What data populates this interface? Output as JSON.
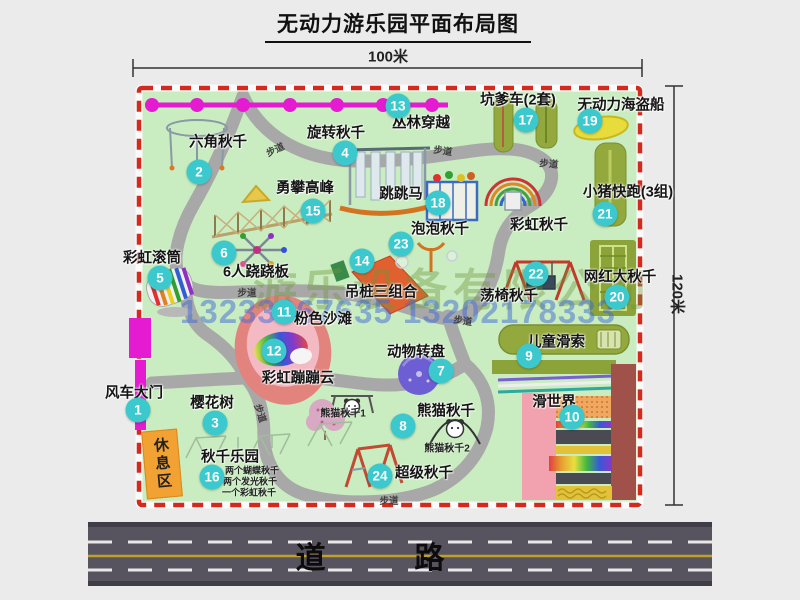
{
  "title": "无动力游乐园平面布局图",
  "dimensions": {
    "top": "100米",
    "right": "120米"
  },
  "road": {
    "label": "道  路"
  },
  "rest_area": {
    "label": "休息区"
  },
  "watermark": {
    "company": "游乐设备有限公司",
    "phones": "13233867635 13202178333"
  },
  "colors": {
    "park_green": "#c9ecc0",
    "border_red": "#d4291c",
    "badge_teal": "#3cc9cd",
    "road_gray": "#57535f",
    "zipline_magenta": "#e41bd0",
    "rest_area_orange": "#f2a233",
    "watermark_green": "rgba(110,150,60,0.40)",
    "watermark_blue": "rgba(64,106,216,0.50)"
  },
  "attractions": [
    {
      "num": "1",
      "label": "风车大门",
      "badge": [
        138,
        410
      ],
      "text": [
        134,
        392
      ]
    },
    {
      "num": "2",
      "label": "六角秋千",
      "badge": [
        199,
        172
      ],
      "text": [
        218,
        141
      ]
    },
    {
      "num": "3",
      "label": "樱花树",
      "badge": [
        215,
        423
      ],
      "text": [
        212,
        402
      ]
    },
    {
      "num": "4",
      "label": "旋转秋千",
      "badge": [
        345,
        153
      ],
      "text": [
        336,
        132
      ]
    },
    {
      "num": "5",
      "label": "彩虹滚筒",
      "badge": [
        160,
        278
      ],
      "text": [
        152,
        257
      ]
    },
    {
      "num": "6",
      "label": "6人跷跷板",
      "badge": [
        224,
        253
      ],
      "text": [
        256,
        271
      ]
    },
    {
      "num": "7",
      "label": "动物转盘",
      "badge": [
        441,
        371
      ],
      "text": [
        416,
        351
      ]
    },
    {
      "num": "8",
      "label": "熊猫秋千",
      "badge": [
        403,
        426
      ],
      "text": [
        446,
        410
      ]
    },
    {
      "num": "9",
      "label": "儿童滑索",
      "badge": [
        529,
        356
      ],
      "text": [
        556,
        341
      ]
    },
    {
      "num": "10",
      "label": "滑世界",
      "badge": [
        572,
        417
      ],
      "text": [
        554,
        401
      ]
    },
    {
      "num": "11",
      "label": "粉色沙滩",
      "badge": [
        284,
        312
      ],
      "text": [
        323,
        318
      ]
    },
    {
      "num": "12",
      "label": "彩虹蹦蹦云",
      "badge": [
        274,
        351
      ],
      "text": [
        298,
        377
      ]
    },
    {
      "num": "13",
      "label": "丛林穿越",
      "badge": [
        398,
        106
      ],
      "text": [
        421,
        122
      ]
    },
    {
      "num": "14",
      "label": "吊桩三组合",
      "badge": [
        362,
        261
      ],
      "text": [
        381,
        291
      ]
    },
    {
      "num": "15",
      "label": "勇攀高峰",
      "badge": [
        313,
        211
      ],
      "text": [
        305,
        187
      ]
    },
    {
      "num": "16",
      "label": "秋千乐园",
      "badge": [
        212,
        477
      ],
      "text": [
        230,
        456
      ]
    },
    {
      "num": "17",
      "label": "坑爹车(2套)",
      "badge": [
        526,
        120
      ],
      "text": [
        518,
        99
      ]
    },
    {
      "num": "18",
      "label": "跳跳马",
      "badge": [
        438,
        203
      ],
      "text": [
        401,
        193
      ]
    },
    {
      "num": "19",
      "label": "无动力海盗船",
      "badge": [
        590,
        121
      ],
      "text": [
        621,
        104
      ]
    },
    {
      "num": "20",
      "label": "网红大秋千",
      "badge": [
        617,
        297
      ],
      "text": [
        620,
        276
      ]
    },
    {
      "num": "21",
      "label": "小猪快跑(3组)",
      "badge": [
        605,
        214
      ],
      "text": [
        628,
        191
      ]
    },
    {
      "num": "22",
      "label": "荡椅秋千",
      "badge": [
        536,
        274
      ],
      "text": [
        509,
        295
      ]
    },
    {
      "num": "23",
      "label": "泡泡秋千",
      "badge": [
        401,
        244
      ],
      "text": [
        440,
        228
      ]
    },
    {
      "num": "24",
      "label": "超级秋千",
      "badge": [
        380,
        476
      ],
      "text": [
        424,
        472
      ]
    }
  ],
  "notes": [
    {
      "text": "彩虹秋千",
      "pos": [
        539,
        224
      ],
      "size": "normal"
    },
    {
      "text": "熊猫秋千1",
      "pos": [
        343,
        412
      ],
      "size": "small"
    },
    {
      "text": "熊猫秋千2",
      "pos": [
        447,
        447
      ],
      "size": "small"
    },
    {
      "text": "两个蝴蝶秋千",
      "pos": [
        252,
        470
      ],
      "size": "tiny"
    },
    {
      "text": "两个发光秋千",
      "pos": [
        250,
        481
      ],
      "size": "tiny"
    },
    {
      "text": "一个彩虹秋千",
      "pos": [
        249,
        492
      ],
      "size": "tiny"
    }
  ],
  "path_labels": [
    {
      "text": "步道",
      "pos": [
        275,
        149
      ],
      "rot": -25
    },
    {
      "text": "步道",
      "pos": [
        443,
        150
      ],
      "rot": 8
    },
    {
      "text": "步道",
      "pos": [
        549,
        163
      ],
      "rot": 5
    },
    {
      "text": "步道",
      "pos": [
        247,
        292
      ],
      "rot": 0
    },
    {
      "text": "步道",
      "pos": [
        463,
        320
      ],
      "rot": 8
    },
    {
      "text": "步道",
      "pos": [
        261,
        413
      ],
      "rot": 72
    },
    {
      "text": "步道",
      "pos": [
        389,
        500
      ],
      "rot": 0
    }
  ]
}
